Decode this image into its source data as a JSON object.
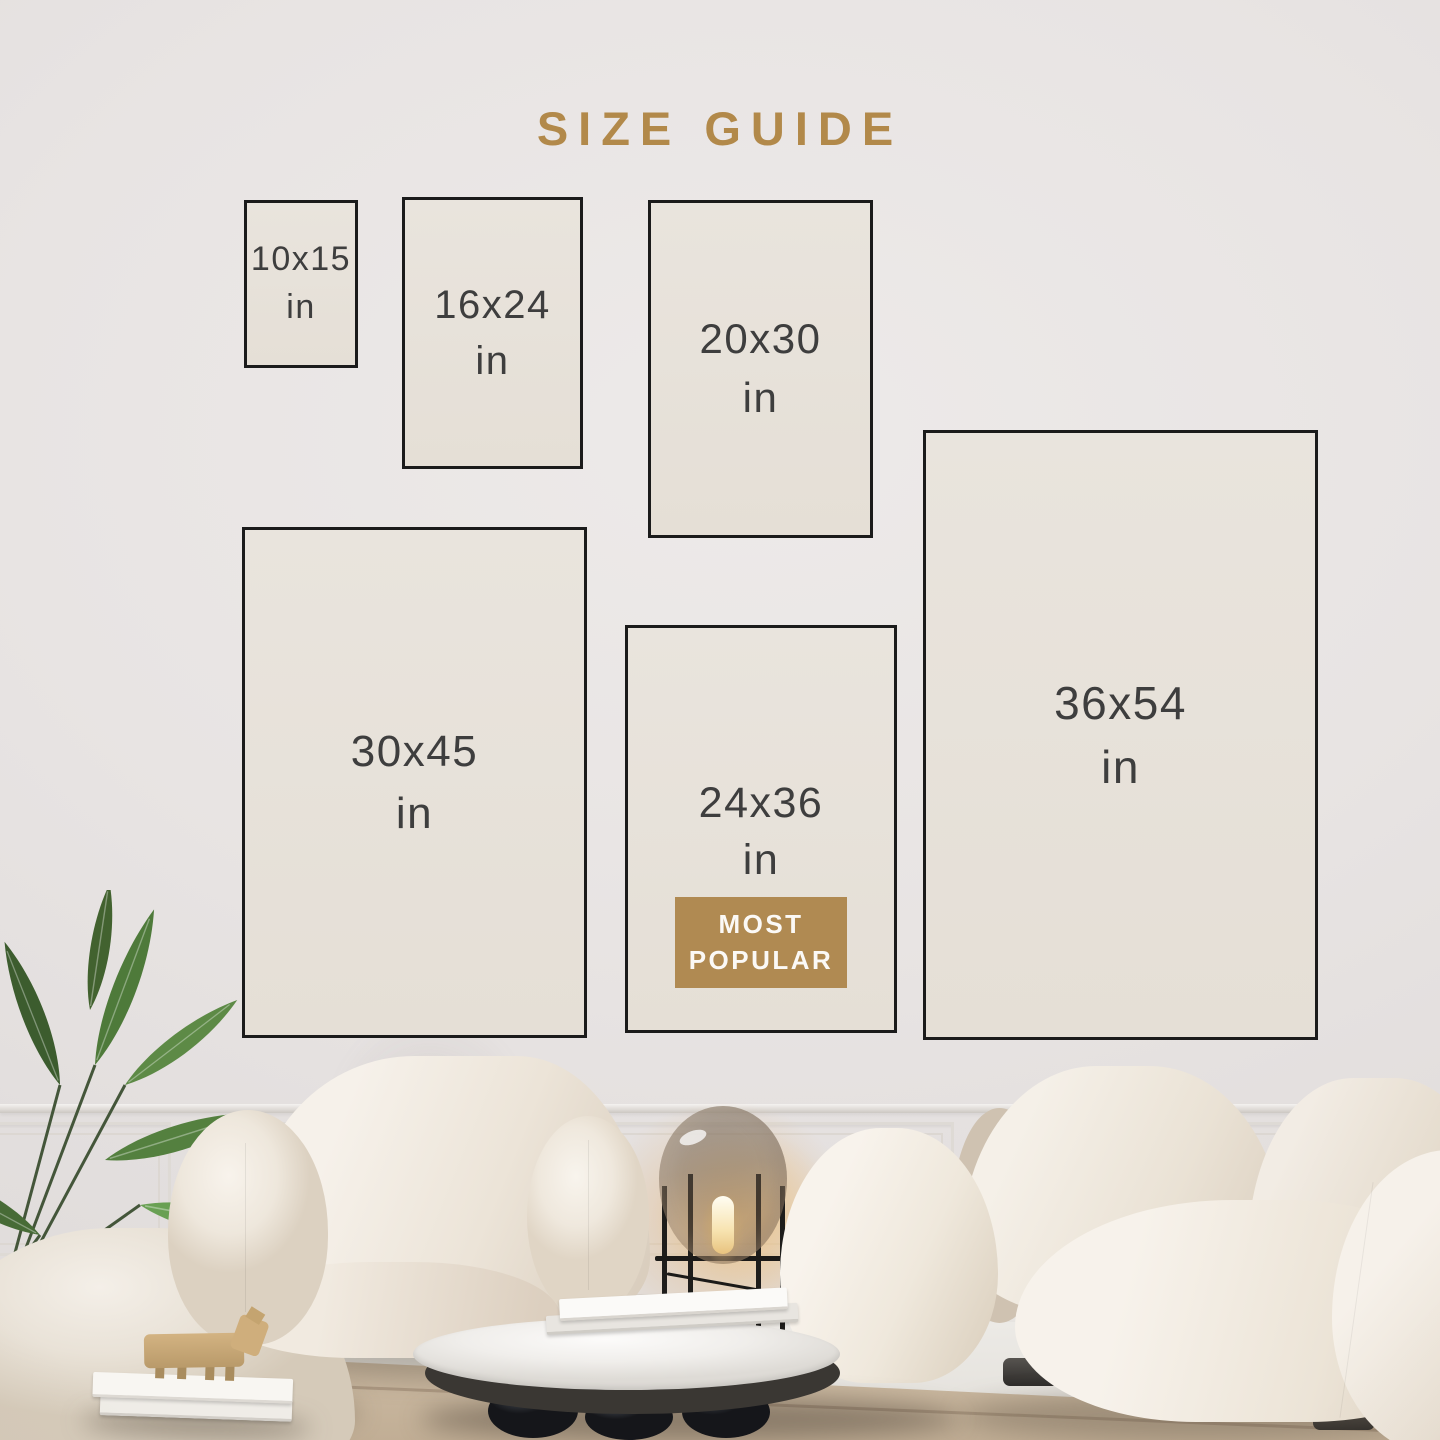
{
  "title": {
    "text": "SIZE GUIDE",
    "color": "#b2894a"
  },
  "sizes": [
    {
      "label": "10x15",
      "unit": "in",
      "most_popular": false
    },
    {
      "label": "16x24",
      "unit": "in",
      "most_popular": false
    },
    {
      "label": "20x30",
      "unit": "in",
      "most_popular": false
    },
    {
      "label": "30x45",
      "unit": "in",
      "most_popular": false
    },
    {
      "label": "24x36",
      "unit": "in",
      "most_popular": true
    },
    {
      "label": "36x54",
      "unit": "in",
      "most_popular": false
    }
  ],
  "badge": {
    "line1": "MOST",
    "line2": "POPULAR",
    "background": "#b08a52",
    "text_color": "#fbf9f6"
  },
  "palette": {
    "wall": "#e8e4e3",
    "swatch_fill": "#e7e1d9",
    "swatch_border": "#1b1b1b",
    "label_text": "#3e3e3e",
    "accent_gold": "#b2894a",
    "rug": "#c9b7a0",
    "leaf_green": "#4e7a3a",
    "lamp_glow": "#e3ae69"
  },
  "scene_objects": [
    "palm-plant",
    "ottoman",
    "lounge-armchair",
    "glass-floor-lamp",
    "boucle-sofa",
    "marble-coffee-table",
    "book-stack",
    "wood-figurine",
    "wainscot-wall",
    "area-rug"
  ]
}
